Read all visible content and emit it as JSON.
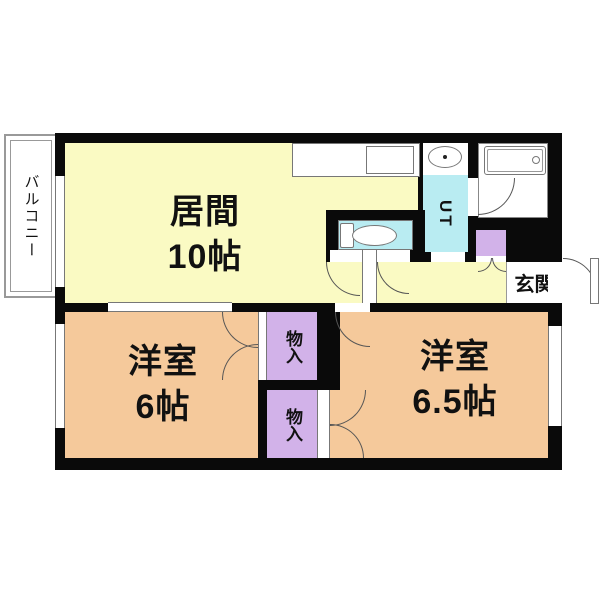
{
  "floorplan": {
    "title": "2DK apartment floor plan",
    "balcony": {
      "label": "バルコニー"
    },
    "living": {
      "name": "居間",
      "size": "10帖"
    },
    "ut": {
      "label": "UT"
    },
    "entrance": {
      "label": "玄関"
    },
    "room_west": {
      "name": "洋室",
      "size": "6帖"
    },
    "room_east": {
      "name": "洋室",
      "size": "6.5帖"
    },
    "closet_upper": {
      "label": "物入"
    },
    "closet_lower": {
      "label": "物入"
    },
    "colors": {
      "wall": "#0a0a0a",
      "living_fill": "#fafac3",
      "bedroom_fill": "#f5c99b",
      "closet_fill": "#d2b2e9",
      "water_fill": "#b9ecf2",
      "line": "#555555"
    }
  }
}
